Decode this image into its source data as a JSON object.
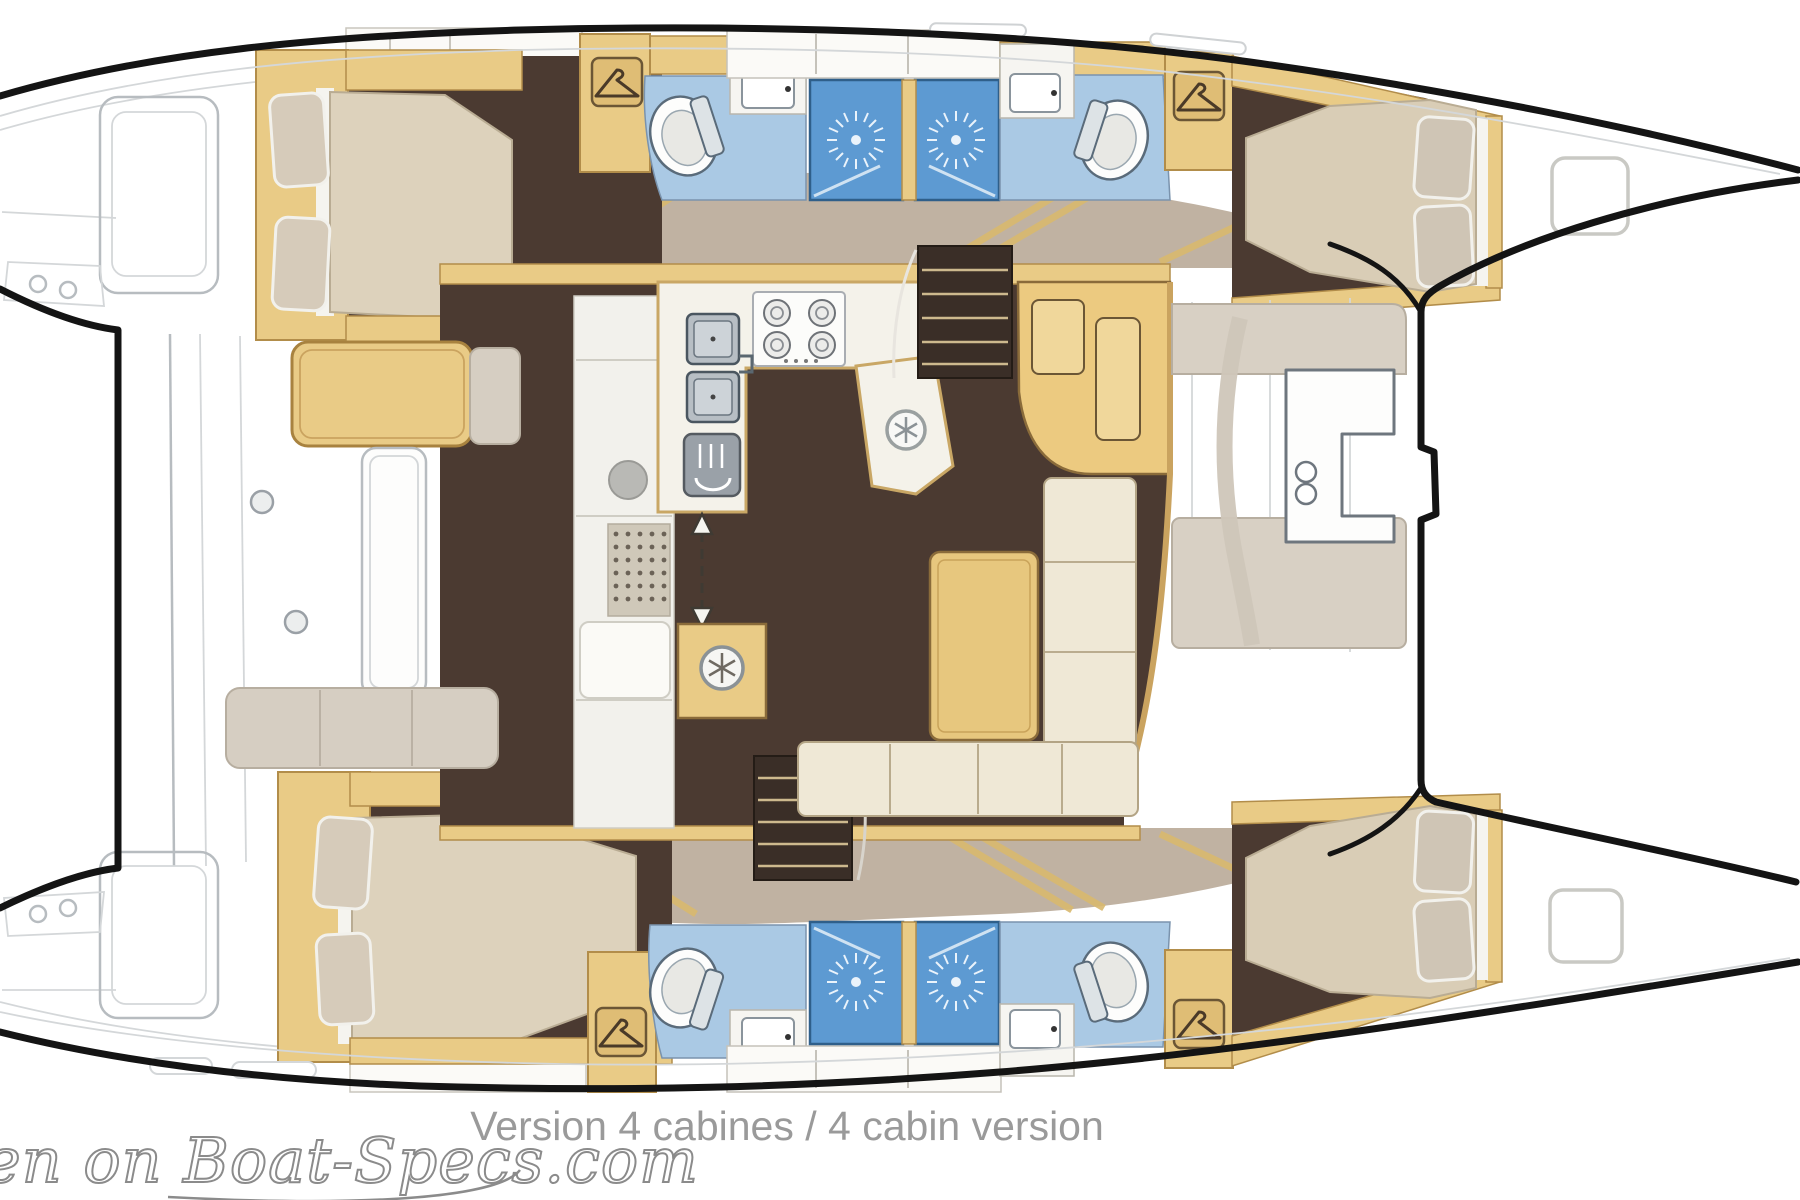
{
  "diagram": {
    "type": "boat-floor-plan",
    "subject": "catamaran interior layout, top view",
    "caption": {
      "text": "Version 4 cabines / 4 cabin version"
    },
    "watermark": {
      "text": "en on Boat-Specs.com"
    }
  },
  "layout_features": {
    "cabins_with_double_bed": 4,
    "bathrooms": 4,
    "shower_stalls": 4,
    "wardrobe_hanger_icons": 4,
    "galley": [
      "double-sink",
      "4-burner-stove",
      "oven",
      "fridge-snowflake",
      "freezer-snowflake"
    ],
    "saloon": [
      "l-shaped-sofa",
      "table",
      "nav-station"
    ],
    "companionway_arrow": "double-headed dashed arrow at galley passage"
  },
  "colors": {
    "hull_floor_dark": "#4b3a31",
    "wood_trim": "#e9cb86",
    "wood_trim_dark": "#8a6b3a",
    "mattress": "#d9cdb6",
    "pillow": "#cfc5b5",
    "bathroom_floor": "#aac9e4",
    "shower_stall": "#5d9ad2",
    "sofa_cream": "#efe8d6",
    "table_wood": "#e7c77e",
    "walkway_taupe": "#b2a18d",
    "deck_pad_greige": "#d8d0c4",
    "counter_white": "#f4f2ea",
    "appliance_gray": "#9aa1a8",
    "line_art_gray": "#b7bcc0",
    "outline_black": "#141414",
    "caption_gray": "#9a9a9a"
  }
}
